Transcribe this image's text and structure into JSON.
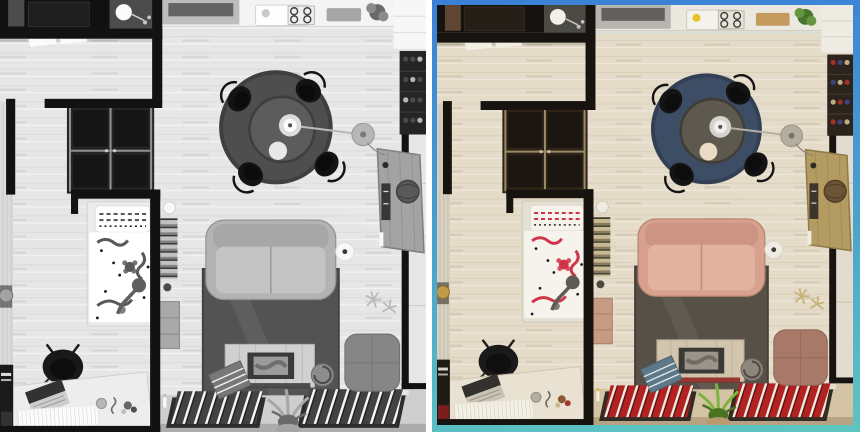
{
  "image": {
    "kind": "before-after-colorization-comparison",
    "subject": "top-down 3d render of a studio apartment"
  },
  "panels": {
    "left": {
      "id": "grayscale-before",
      "framed": false
    },
    "right": {
      "id": "color-after",
      "framed": true,
      "frame_gradient": [
        "#3b80d7",
        "#4aa3cd",
        "#5ec5c0"
      ]
    }
  },
  "scene_objects": [
    "kitchen-counter",
    "range-hood",
    "sink",
    "stove",
    "cutting-board",
    "potted-plant",
    "white-cabinet",
    "wine-rack",
    "dining-rug",
    "dining-table",
    "dining-chairs",
    "pendant-lamp",
    "floor-lamp",
    "hallway-doors",
    "entry-dark-room",
    "wardrobe-closet",
    "curtain",
    "teapot",
    "bed",
    "pillow",
    "duvet",
    "desk-chair",
    "bedroom-desk",
    "laptop",
    "white-fringe",
    "corner-shelf",
    "bookshelf-column",
    "dresser",
    "sofa",
    "speaker",
    "living-rug",
    "tv-console",
    "ottoman-pouf",
    "red-book-trays",
    "green-plant",
    "blue-book-stack",
    "round-sculpture",
    "antler-decor",
    "side-desk",
    "woven-globe",
    "window-sill"
  ],
  "palette": {
    "bg": "#ffffff",
    "border_top": "#3b80d7",
    "border_mid": "#4aa3cd",
    "border_bottom": "#5ec5c0",
    "wall": "#17130f",
    "floor": "#e4dbc8",
    "floor_line": "#b3a184",
    "darkroom": "#15120f",
    "darkroom_door": "#5e4632",
    "darkroom_cabinet": "#241e17",
    "bathroom": "#4b4a45",
    "lamp_white": "#f2efe7",
    "counter": "#ebe8e0",
    "counter_gray": "#b7b5af",
    "hood": "#63615d",
    "sink": "#f4f2ec",
    "stove": "#3e3c38",
    "lemon": "#e6c31e",
    "board": "#c59a5e",
    "plant_dark": "#49742e",
    "plant_light": "#66963f",
    "cabinet_white": "#eeebe2",
    "corner_beige": "#ded6c6",
    "rack": "#2b241d",
    "bottle_red": "#a33026",
    "bottle_blue": "#41447c",
    "bottle_tan": "#c3ac80",
    "dining_rug": "#3e4d66",
    "dining_rug_edge": "#333f54",
    "table": "#5d594e",
    "table_edge": "#403d35",
    "metal": "#d2d2d0",
    "metal_light": "#f0efec",
    "chair_black": "#141414",
    "cup": "#e9dcc2",
    "lamp_gray": "#b5ae9f",
    "desk_wood": "#b49b62",
    "desk_edge": "#8f7a48",
    "globe": "#6b5436",
    "curtain": "#d8d0c0",
    "teapot": "#c09a4a",
    "closet": "#2e2317",
    "closet_frame": "#9b8a66",
    "closet_glass": "#1c1611",
    "bedframe": "#e5e0d4",
    "duvet": "#f6f3ed",
    "red_pattern": "#d03448",
    "branch": "#5c5c55",
    "desk2": "#e9e1d1",
    "laptop": "#33312d",
    "keyboard": "#c9c3b5",
    "fringe": "#f6f4ee",
    "shelf_dark": "#1f1a14",
    "book_darkred": "#7c1d1d",
    "shelf_books_a": "#c9b894",
    "shelf_books_b": "#8a7a5e",
    "dresser_pink": "#c79a84",
    "sofa": "#d8a18e",
    "sofa_seat": "#e2b2a0",
    "sofa_edge": "#c08a78",
    "speaker": "#efece4",
    "living_rug": "#575047",
    "console": "#d2c5ae",
    "console_dark": "#3b3936",
    "screen": "#9a948a",
    "hearth": "#d4c3a4",
    "hearth_dark": "#b5a383",
    "tray": "#332c22",
    "book_red": "#b32222",
    "book_white": "#efeade",
    "plant2": "#7cb53c",
    "plant2_dark": "#4a7422",
    "pot": "#b89a6e",
    "blue_books": "#5f7889",
    "sculpture": "#8e867c",
    "pouf": "#a87868",
    "pouf_dark": "#8f6355",
    "antler": "#c9b277",
    "sill": "#e3dcce"
  }
}
